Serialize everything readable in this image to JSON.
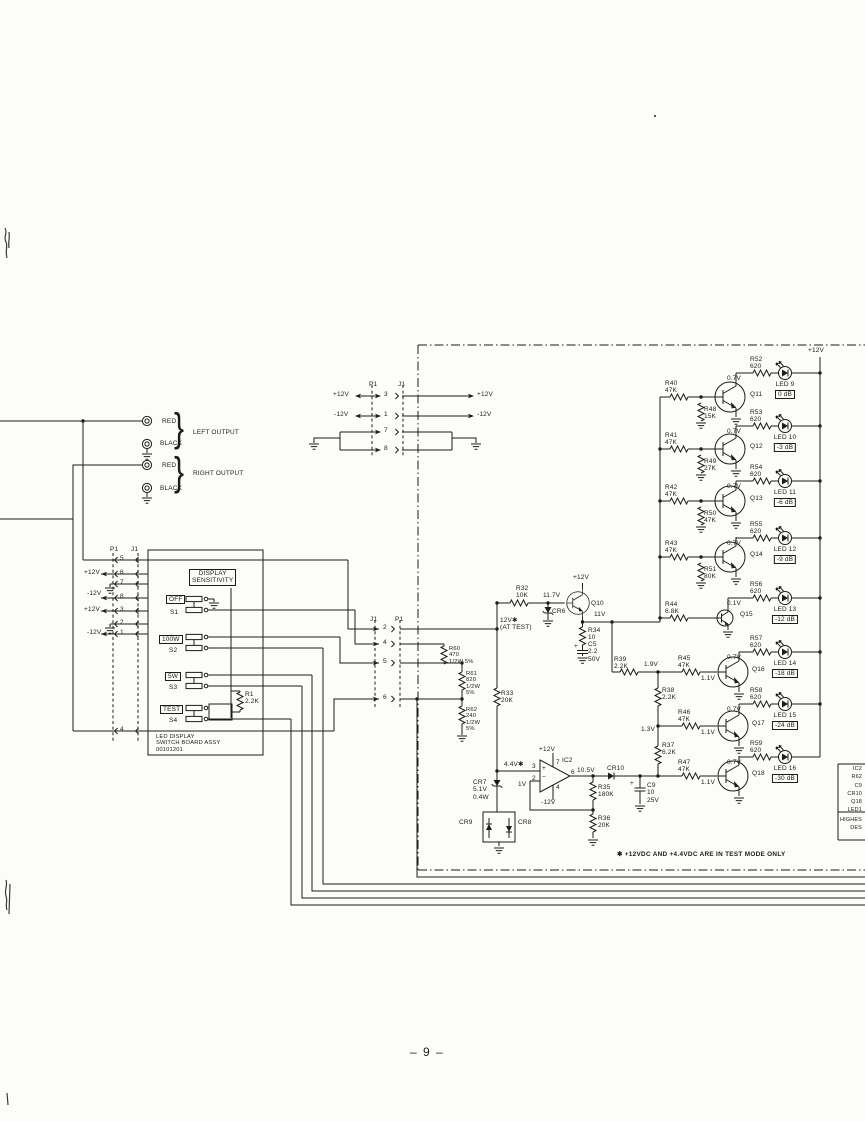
{
  "page": {
    "number": "– 9 –",
    "note": "✱ +12VDC AND +4.4VDC ARE IN TEST MODE ONLY"
  },
  "outputs": {
    "left": {
      "pos": "RED",
      "neg": "BLACK",
      "label": "LEFT OUTPUT"
    },
    "right": {
      "pos": "RED",
      "neg": "BLACK",
      "label": "RIGHT OUTPUT"
    },
    "brace": "}"
  },
  "top_connector": {
    "p": "P1",
    "j": "J1",
    "rows": [
      {
        "pin": "3",
        "l": "+12V",
        "r": "+12V"
      },
      {
        "pin": "1",
        "l": "-12V",
        "r": "-12V"
      },
      {
        "pin": "7",
        "l": "",
        "r": ""
      },
      {
        "pin": "8",
        "l": "",
        "r": ""
      }
    ]
  },
  "board": {
    "p": "P1",
    "j": "J1",
    "pins": {
      "p5": "5",
      "p6": "6",
      "p7": "7",
      "p8": "8",
      "p3": "3",
      "p2": "2",
      "p1": "1",
      "p4": "4"
    },
    "rails": {
      "v6": "+12V",
      "v8": "-12V",
      "v3": "+12V",
      "v1": "-12V"
    },
    "title": "DISPLAY\nSENSITIVITY",
    "switches": [
      {
        "name": "OFF",
        "ref": "S1"
      },
      {
        "name": "100W",
        "ref": "S2"
      },
      {
        "name": "5W",
        "ref": "S3"
      },
      {
        "name": "TEST",
        "ref": "S4"
      }
    ],
    "r1": "R1\n2.2K",
    "caption": "LED DISPLAY\nSWITCH BOARD ASSY\n00101201"
  },
  "mid_connector": {
    "j": "J1",
    "p": "P1",
    "pins": [
      "2",
      "4",
      "5",
      "6"
    ],
    "test_label": "12V✱\n(AT TEST)"
  },
  "divider": {
    "r60": "R60\n470\n1/2W 5%",
    "r61": "R61\n820\n1/2W\n5%",
    "r62": "R62\n240\n1/2W\n5%",
    "r33": "R33\n20K"
  },
  "driver": {
    "r32": "R32\n10K",
    "v_in": "11.7V",
    "cr6": "CR6",
    "q": "Q10",
    "vcc": "+12V",
    "v_out": "11V",
    "r34": "R34\n10",
    "c5": "C5\n2.2\n50V",
    "c5_plus": "+",
    "r39": "R39\n2.2K",
    "n19": "1.9V",
    "r38": "R38\n2.2K",
    "n13": "1.3V",
    "r37": "R37\n6.2K"
  },
  "opamp": {
    "ref": "IC2",
    "vp": "+12V",
    "vn": "-12V",
    "pin3": "3",
    "pin2": "2",
    "pin7": "7",
    "pin4": "4",
    "pin6": "6",
    "plus": "+",
    "minus": "−",
    "vin": "4.4V✱",
    "vfb": "1V",
    "vout": "10.5V",
    "r35": "R35\n180K",
    "r36": "R36\n20K",
    "cr10": "CR10",
    "c9": "C9\n10\n25V",
    "c9_plus": "+",
    "cr7": "CR7\n5.1V\n0.4W",
    "cr9": "CR9",
    "cr8": "CR8"
  },
  "rail": {
    "label": "+12V"
  },
  "stages": [
    {
      "q": "Q11",
      "rb": "R40\n47K",
      "rg": "R48\n15K",
      "rl": "R52\n620",
      "vc": "0.7V",
      "led": "LED 9",
      "db": "0 dB"
    },
    {
      "q": "Q12",
      "rb": "R41\n47K",
      "rg": "R49\n27K",
      "rl": "R53\n620",
      "vc": "0.7V",
      "led": "LED 10",
      "db": "-3 dB"
    },
    {
      "q": "Q13",
      "rb": "R42\n47K",
      "rg": "R50\n47K",
      "rl": "R54\n620",
      "vc": "0.7V",
      "led": "LED 11",
      "db": "-6 dB"
    },
    {
      "q": "Q14",
      "rb": "R43\n47K",
      "rg": "R51\n80K",
      "rl": "R55\n620",
      "vc": "0.7V",
      "led": "LED 12",
      "db": "-9 dB"
    },
    {
      "q": "Q15",
      "rb": "R44\n6.8K",
      "rl": "R56\n620",
      "vc": "0.1V",
      "led": "LED 13",
      "db": "-12 dB"
    },
    {
      "q": "Q16",
      "rb": "R45\n47K",
      "rl": "R57\n620",
      "vc": "0.7V",
      "vb": "1.1V",
      "led": "LED 14",
      "db": "-18 dB"
    },
    {
      "q": "Q17",
      "rb": "R46\n47K",
      "rl": "R58\n620",
      "vc": "0.7V",
      "vb": "1.1V",
      "led": "LED 15",
      "db": "-24 dB"
    },
    {
      "q": "Q18",
      "rb": "R47\n47K",
      "rl": "R59\n620",
      "vc": "0.7V",
      "vb": "1.1V",
      "led": "LED 16",
      "db": "-30 dB"
    }
  ],
  "designators": {
    "lines": "IC2\nR62\nC9\nCR10\nQ18\nLED1",
    "footer": "HIGHES\nDES"
  }
}
